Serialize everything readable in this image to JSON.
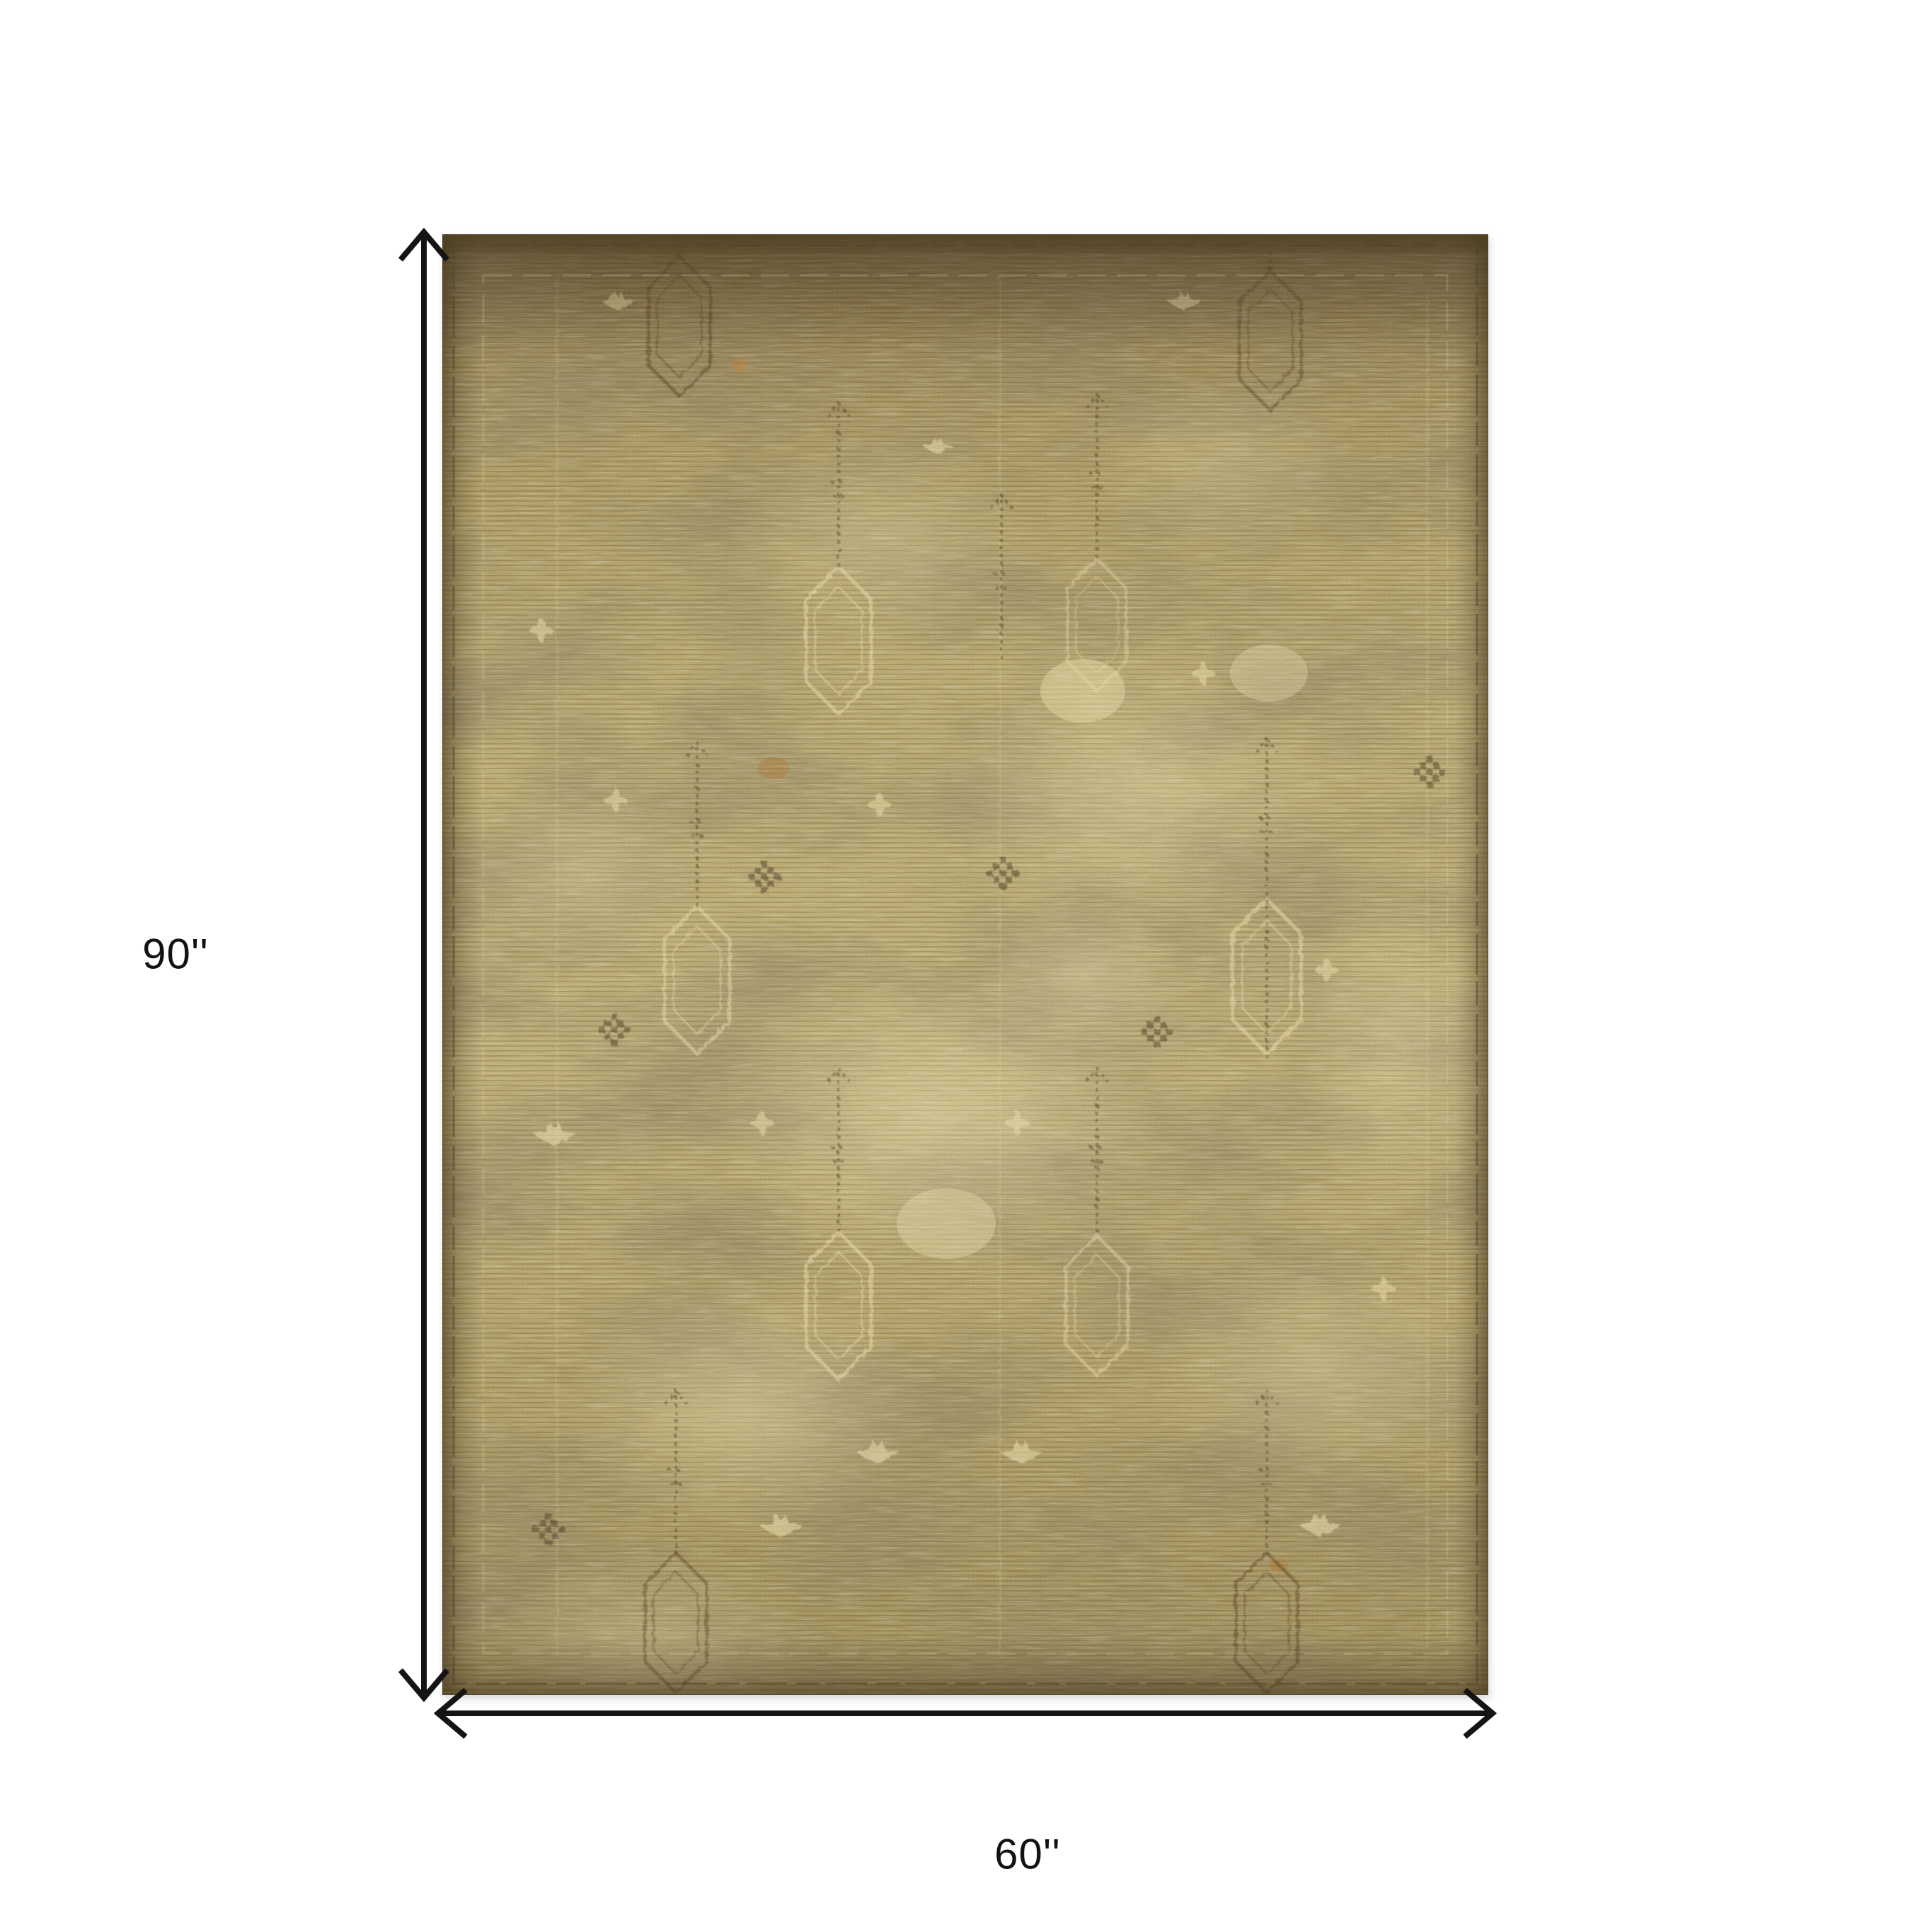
{
  "diagram": {
    "height_label": "90''",
    "width_label": "60''",
    "arrow_color": "#141414",
    "label_color": "#121212",
    "background": "#ffffff"
  },
  "rug": {
    "alt": "Distressed vintage gold and olive oriental area rug with faded lantern medallion motifs",
    "colors": {
      "base": "#b9a972",
      "base_dark": "#8d7a4e",
      "top_band": "#5a482a",
      "motif_cream": "#ead9a8",
      "motif_dark": "#5a4527",
      "accent_rust": "#b5722f",
      "edge_line": "#55462a"
    }
  }
}
